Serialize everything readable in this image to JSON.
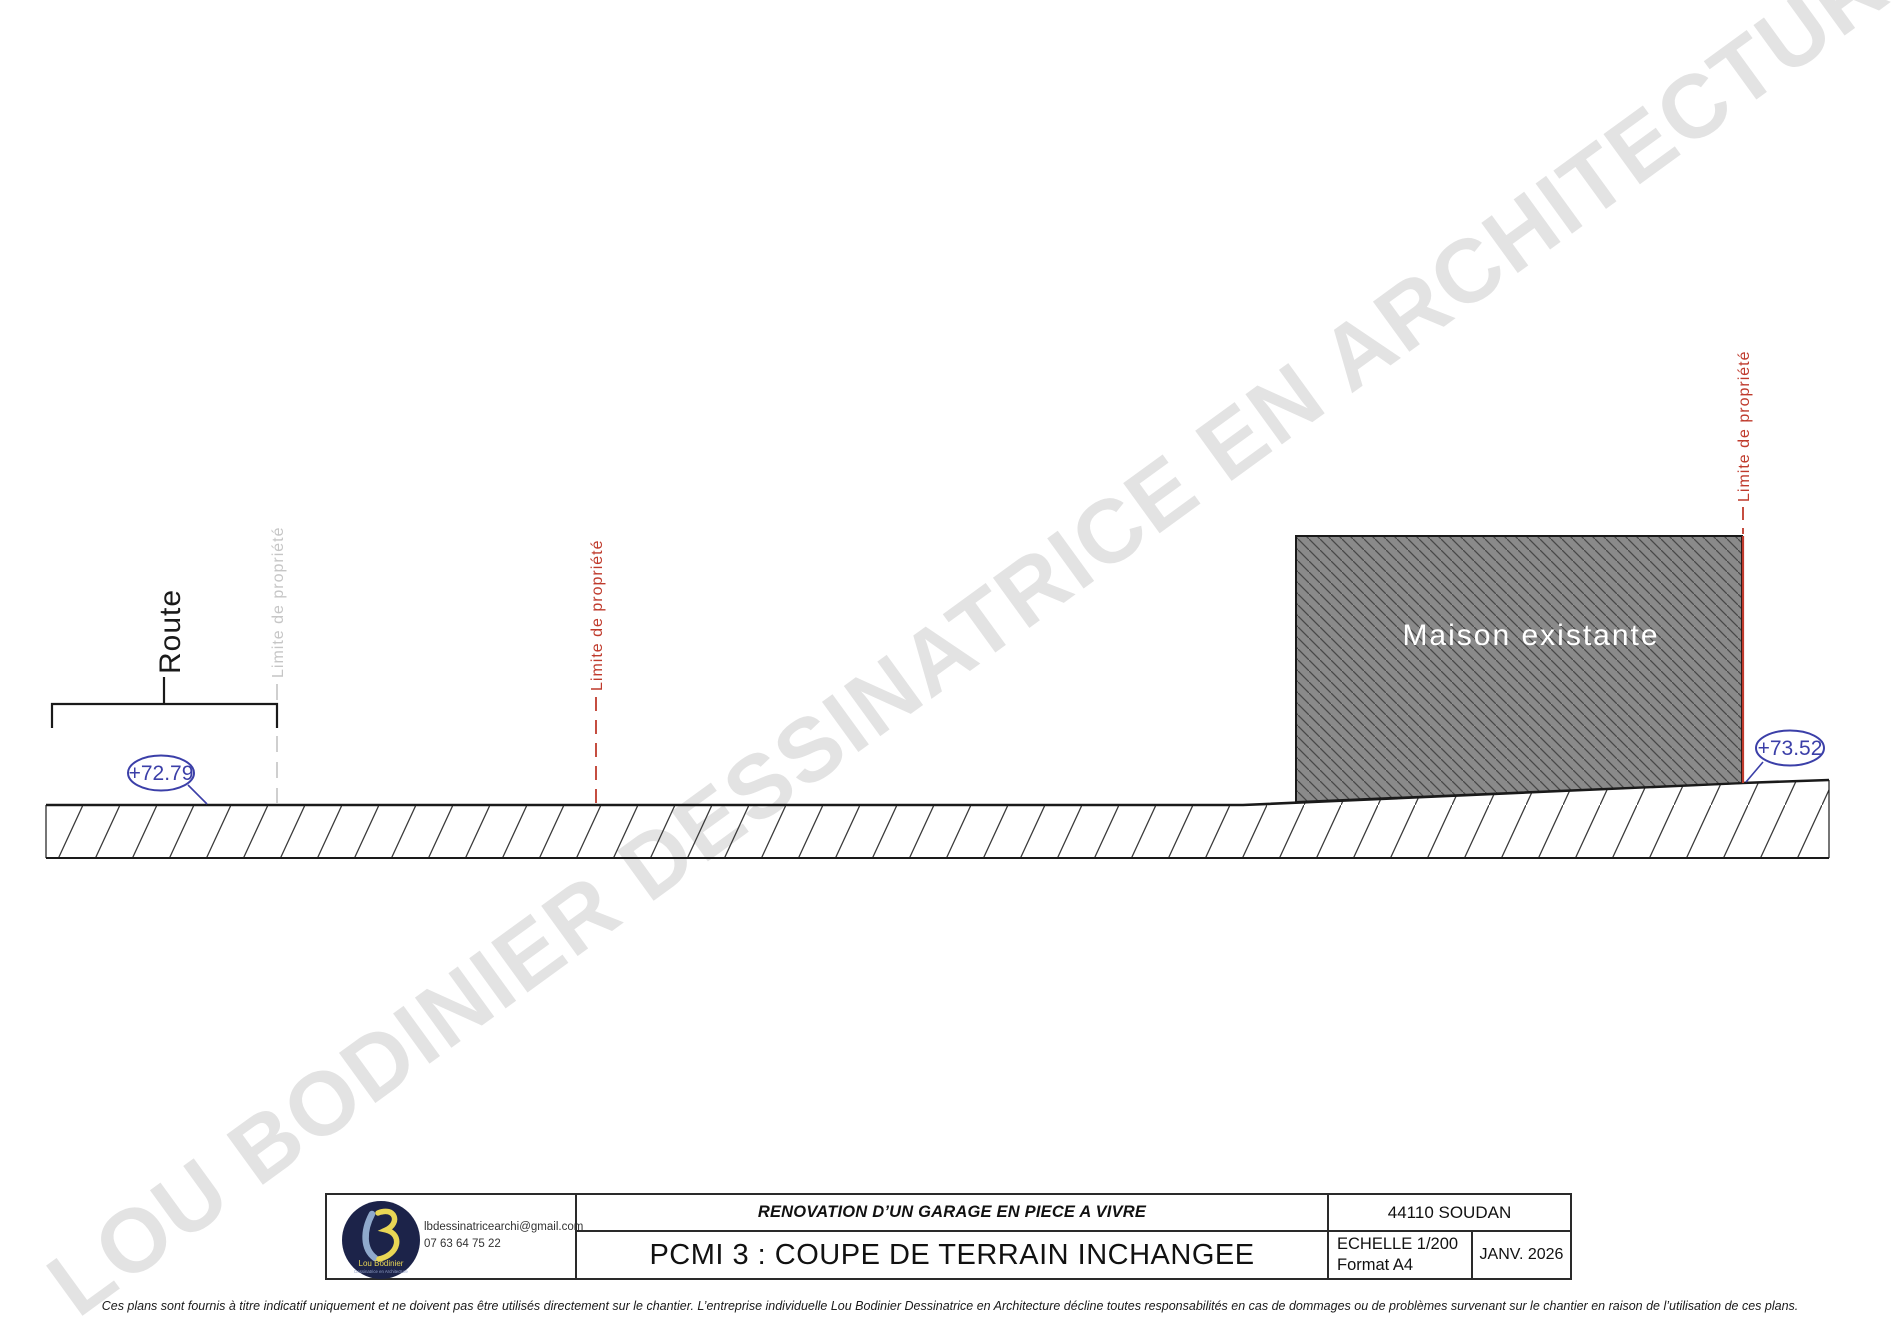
{
  "watermark": {
    "text": "LOU BODINIER DESSINATRICE EN ARCHITECTURE",
    "color": "#e3e3e3"
  },
  "drawing": {
    "route_label": "Route",
    "boundary_left_gray_label": "Limite de propriété",
    "boundary_mid_red_label": "Limite de propriété",
    "boundary_right_red_label": "Limite de propriété",
    "building_label": "Maison existante",
    "elevation_left": "+72.79",
    "elevation_right": "+73.52",
    "colors": {
      "boundary_red": "#bf3a2c",
      "boundary_gray": "#c3c3c3",
      "elevation_blue": "#3b3fa8",
      "building_fill": "#8a8a8a"
    }
  },
  "title_block": {
    "logo": {
      "name": "Lou Bodinier",
      "subtitle": "Dessinatrice en Architecture"
    },
    "contact": {
      "email": "lbdessinatricearchi@gmail.com",
      "phone": "07 63 64 75 22"
    },
    "project_title": "RENOVATION D’UN GARAGE EN PIECE A VIVRE",
    "sheet_title": "PCMI 3 : COUPE DE TERRAIN INCHANGEE",
    "city": "44110 SOUDAN",
    "scale": "ECHELLE 1/200",
    "paper": "Format A4",
    "date": "JANV. 2026"
  },
  "disclaimer": "Ces plans sont fournis à titre indicatif uniquement et ne doivent pas être utilisés directement sur le chantier. L’entreprise individuelle Lou Bodinier Dessinatrice en Architecture décline toutes responsabilités en cas de dommages ou de problèmes survenant sur le chantier en raison de l’utilisation de ces plans."
}
